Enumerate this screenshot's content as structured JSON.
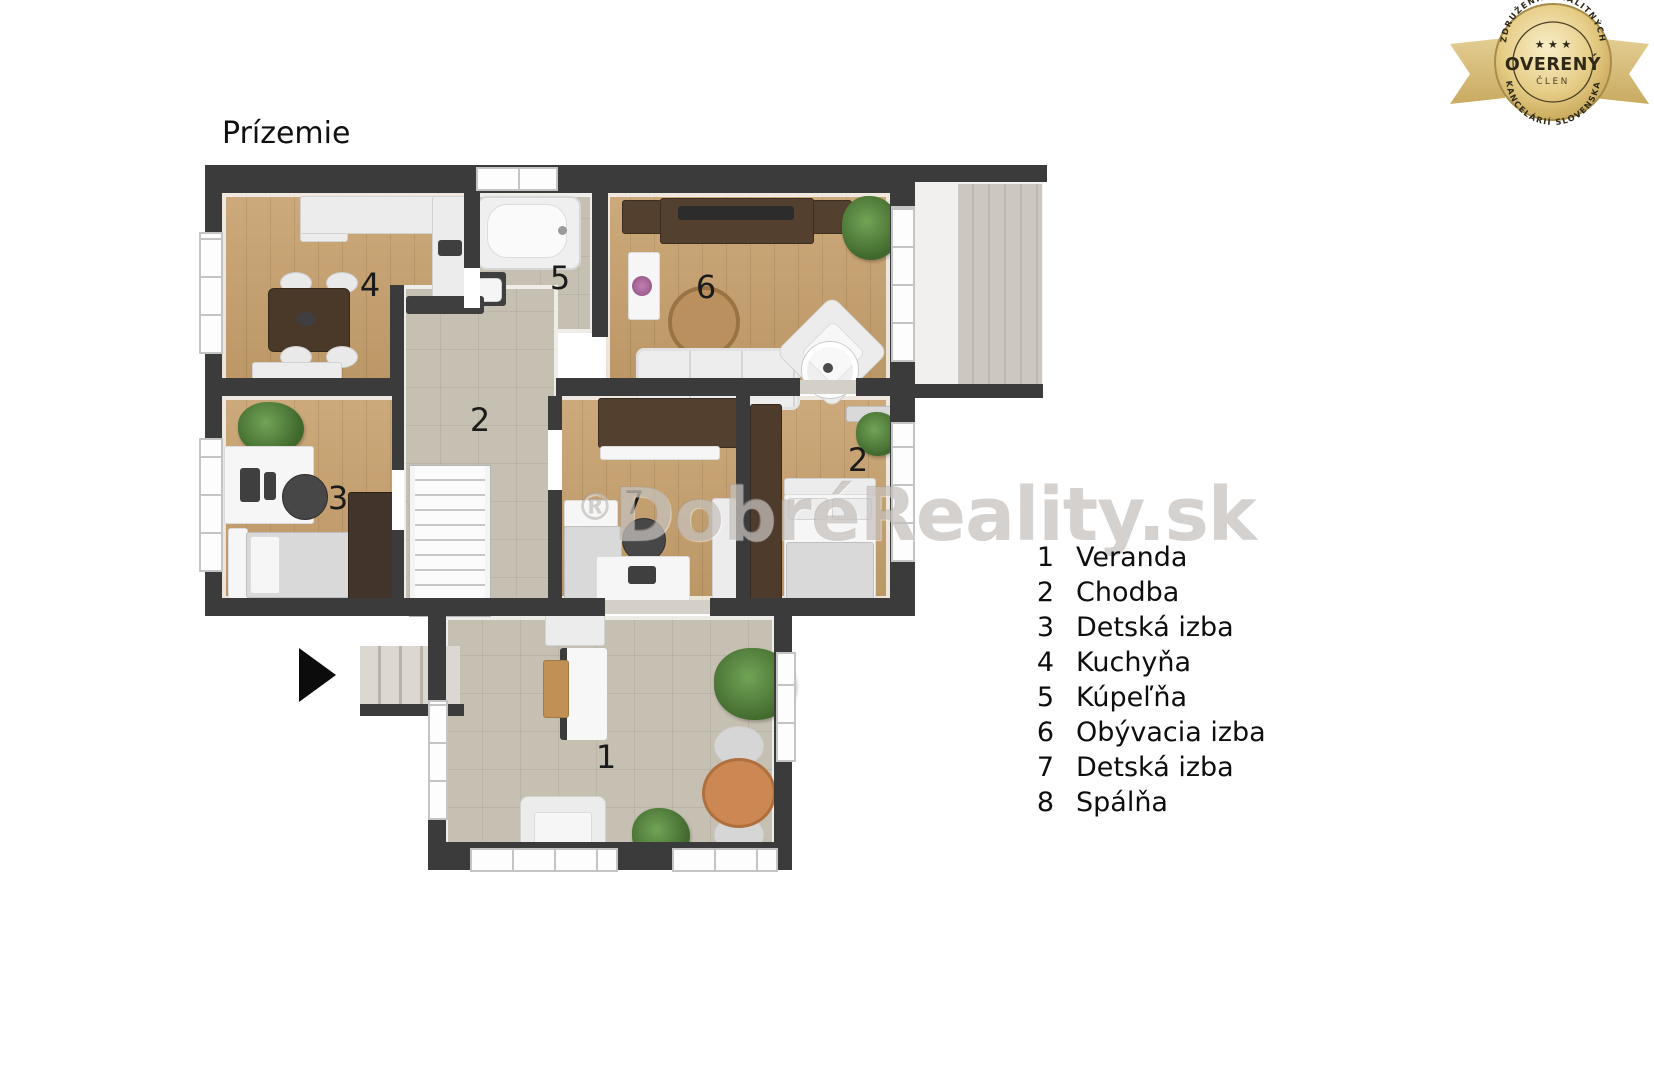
{
  "title": "Prízemie",
  "badge": {
    "top_arc_text": "ZDRUŽENIE REALITNÝCH",
    "bottom_arc_text": "KANCELÁRIÍ SLOVENSKA",
    "center_text": "OVERENÝ",
    "sub_text": "ČLEN",
    "stars": "★ ★ ★",
    "gold_color": "#d9c183",
    "text_color": "#2e2817"
  },
  "watermark": {
    "reg": "®",
    "text": "DobréReality",
    "suffix": ".sk"
  },
  "plan": {
    "labels": [
      {
        "text": "4"
      },
      {
        "text": "5"
      },
      {
        "text": "6"
      },
      {
        "text": "2"
      },
      {
        "text": "3"
      },
      {
        "text": "7"
      },
      {
        "text": "2"
      },
      {
        "text": "1"
      }
    ],
    "colors": {
      "wall": "#3b3b3b",
      "wood_floor": "#c7a06c",
      "tile_floor": "#c6c0b2",
      "dark_wood_furniture": "#54402f",
      "plant_green": "#4f7d3a",
      "veranda_table_orange": "#cd8752"
    }
  },
  "legend": {
    "items": [
      {
        "num": "1",
        "label": "Veranda"
      },
      {
        "num": "2",
        "label": "Chodba"
      },
      {
        "num": "3",
        "label": "Detská izba"
      },
      {
        "num": "4",
        "label": "Kuchyňa"
      },
      {
        "num": "5",
        "label": "Kúpeľňa"
      },
      {
        "num": "6",
        "label": "Obývacia izba"
      },
      {
        "num": "7",
        "label": "Detská izba"
      },
      {
        "num": "8",
        "label": "Spálňa"
      }
    ]
  }
}
